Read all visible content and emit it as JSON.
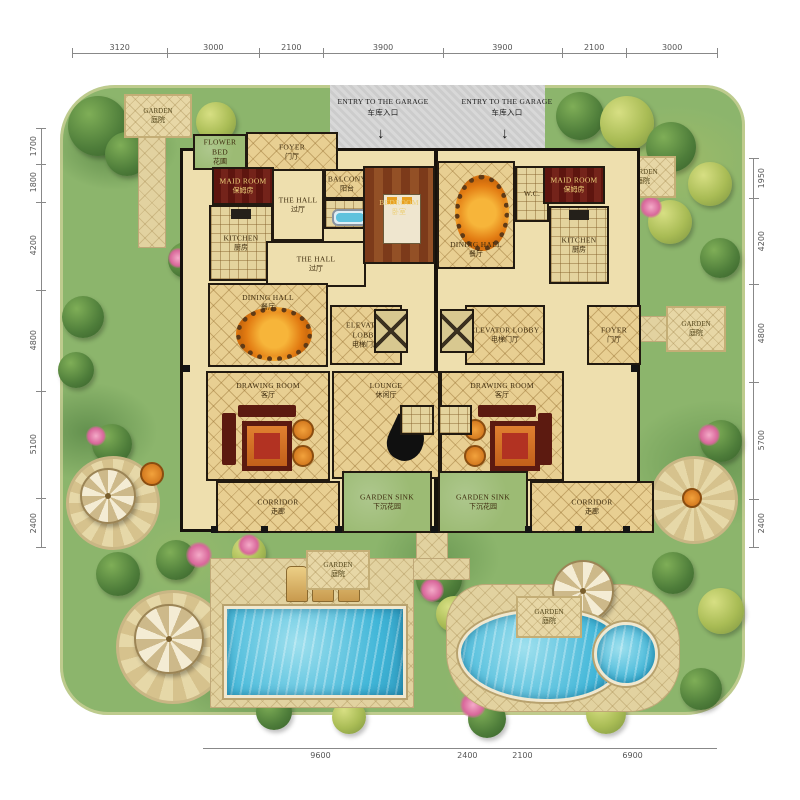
{
  "dimensions": {
    "top": [
      "3120",
      "3000",
      "2100",
      "3900",
      "3900",
      "2100",
      "3000"
    ],
    "left": [
      "1700",
      "1800",
      "4200",
      "4800",
      "5100",
      "2400"
    ],
    "right": [
      "1950",
      "4200",
      "4800",
      "5700",
      "2400"
    ],
    "bottom": [
      "9600",
      "2400",
      "2100",
      "6900"
    ]
  },
  "labels": {
    "flower_bed": {
      "en": "FLOWER BED",
      "zh": "花圃"
    },
    "foyer": {
      "en": "FOYER",
      "zh": "门厅"
    },
    "maid_room": {
      "en": "MAID ROOM",
      "zh": "保姆房"
    },
    "the_hall": {
      "en": "THE HALL",
      "zh": "过厅"
    },
    "kitchen": {
      "en": "KITCHEN",
      "zh": "厨房"
    },
    "balcony": {
      "en": "BALCONY",
      "zh": "阳台"
    },
    "bedroom": {
      "en": "BEDROOM",
      "zh": "卧室"
    },
    "dining_hall": {
      "en": "DINING HALL",
      "zh": "餐厅"
    },
    "wc": {
      "en": "W.C.",
      "zh": ""
    },
    "elevator_lobby": {
      "en": "ELEVATOR LOBBY",
      "zh": "电梯门厅"
    },
    "drawing_room": {
      "en": "DRAWING ROOM",
      "zh": "客厅"
    },
    "lounge": {
      "en": "LOUNGE",
      "zh": "休闲厅"
    },
    "corridor": {
      "en": "CORRIDOR",
      "zh": "走廊"
    },
    "garden_sink": {
      "en": "GARDEN SINK",
      "zh": "下沉花园"
    },
    "garden": {
      "en": "GARDEN",
      "zh": "庭院"
    },
    "garage_entry": {
      "en": "ENTRY TO THE GARAGE",
      "zh": "车库入口"
    }
  },
  "icons": {
    "garage_entry_arrow": "↓"
  },
  "colors": {
    "garden_green": "#8cb56c",
    "floor_cream": "#e8cf92",
    "wall_black": "#17120c",
    "dark_red_room": "#5e150f",
    "pool_blue": "#41b6d8",
    "paving_tan": "#e2d2a0",
    "table_orange": "#e27b12"
  }
}
